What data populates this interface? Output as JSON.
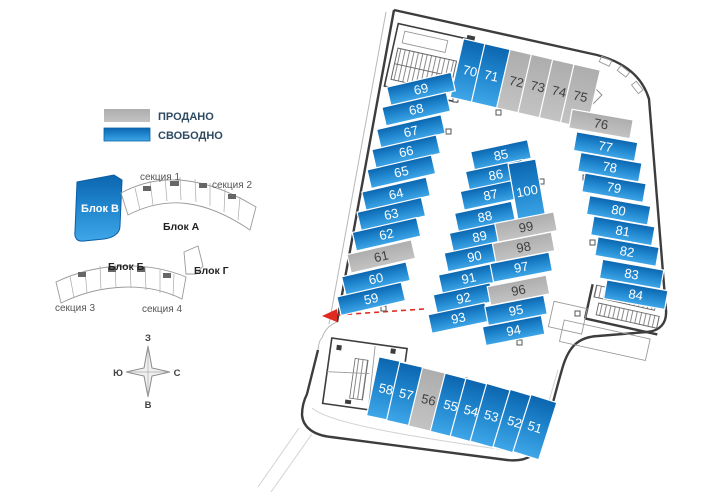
{
  "legend": {
    "items": [
      {
        "label": "ПРОДАНО",
        "status": "sold",
        "color": "#b9b9b9"
      },
      {
        "label": "СВОБОДНО",
        "status": "free",
        "color_top": "#0b65ae",
        "color_bottom": "#3fa6e8"
      }
    ]
  },
  "site_plan": {
    "block_v_label": "Блок В",
    "block_a_label": "Блок А",
    "block_b_label": "Блок Б",
    "block_g_label": "Блок Г",
    "section1_label": "секция 1",
    "section2_label": "секция 2",
    "section3_label": "секция 3",
    "section4_label": "секция 4"
  },
  "compass": {
    "top": "З",
    "left": "Ю",
    "right": "С",
    "bottom": "В"
  },
  "parking": {
    "statuses": {
      "free": "СВОБОДНО",
      "sold": "ПРОДАНО"
    },
    "groups": [
      {
        "name": "top-row",
        "spaces": [
          {
            "num": "70",
            "status": "free"
          },
          {
            "num": "71",
            "status": "free"
          },
          {
            "num": "72",
            "status": "sold"
          },
          {
            "num": "73",
            "status": "sold"
          },
          {
            "num": "74",
            "status": "sold"
          },
          {
            "num": "75",
            "status": "sold"
          }
        ]
      },
      {
        "name": "left-column",
        "spaces": [
          {
            "num": "69",
            "status": "free"
          },
          {
            "num": "68",
            "status": "free"
          },
          {
            "num": "67",
            "status": "free"
          },
          {
            "num": "66",
            "status": "free"
          },
          {
            "num": "65",
            "status": "free"
          },
          {
            "num": "64",
            "status": "free"
          },
          {
            "num": "63",
            "status": "free"
          },
          {
            "num": "62",
            "status": "free"
          },
          {
            "num": "61",
            "status": "sold"
          },
          {
            "num": "60",
            "status": "free"
          },
          {
            "num": "59",
            "status": "free"
          }
        ]
      },
      {
        "name": "right-column",
        "spaces": [
          {
            "num": "76",
            "status": "sold"
          },
          {
            "num": "77",
            "status": "free"
          },
          {
            "num": "78",
            "status": "free"
          },
          {
            "num": "79",
            "status": "free"
          },
          {
            "num": "80",
            "status": "free"
          },
          {
            "num": "81",
            "status": "free"
          },
          {
            "num": "82",
            "status": "free"
          },
          {
            "num": "83",
            "status": "free"
          },
          {
            "num": "84",
            "status": "free"
          }
        ]
      },
      {
        "name": "center-left",
        "spaces": [
          {
            "num": "85",
            "status": "free"
          },
          {
            "num": "86",
            "status": "free"
          },
          {
            "num": "87",
            "status": "free"
          },
          {
            "num": "88",
            "status": "free"
          },
          {
            "num": "89",
            "status": "free"
          },
          {
            "num": "90",
            "status": "free"
          },
          {
            "num": "91",
            "status": "free"
          },
          {
            "num": "92",
            "status": "free"
          },
          {
            "num": "93",
            "status": "free"
          }
        ]
      },
      {
        "name": "center-top",
        "spaces": [
          {
            "num": "100",
            "status": "free"
          }
        ]
      },
      {
        "name": "center-right",
        "spaces": [
          {
            "num": "99",
            "status": "sold"
          },
          {
            "num": "98",
            "status": "sold"
          },
          {
            "num": "97",
            "status": "free"
          },
          {
            "num": "96",
            "status": "sold"
          },
          {
            "num": "95",
            "status": "free"
          },
          {
            "num": "94",
            "status": "free"
          }
        ]
      },
      {
        "name": "bottom-row",
        "spaces": [
          {
            "num": "58",
            "status": "free"
          },
          {
            "num": "57",
            "status": "free"
          },
          {
            "num": "56",
            "status": "sold"
          },
          {
            "num": "55",
            "status": "free"
          },
          {
            "num": "54",
            "status": "free"
          },
          {
            "num": "53",
            "status": "free"
          },
          {
            "num": "52",
            "status": "free"
          },
          {
            "num": "51",
            "status": "free"
          }
        ]
      }
    ]
  }
}
